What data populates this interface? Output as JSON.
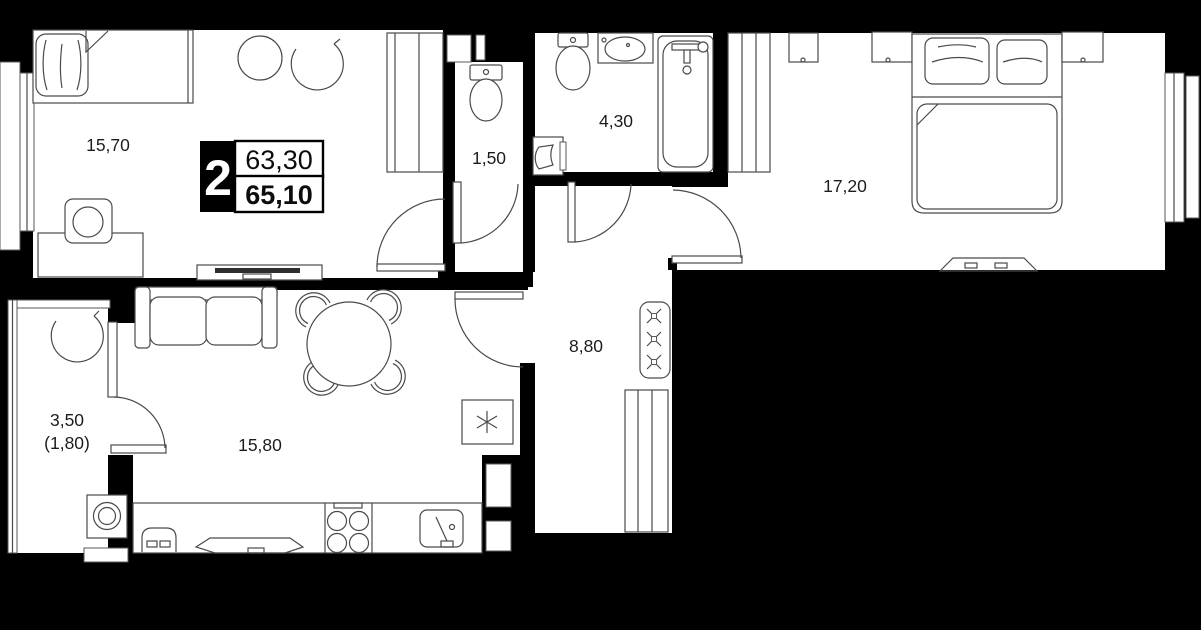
{
  "plan_title": "2-room apartment floor plan",
  "badge": {
    "room_count": "2",
    "area_upper": "63,30",
    "area_lower": "65,10"
  },
  "rooms": {
    "bedroom_1": {
      "label": "15,70"
    },
    "wc": {
      "label": "1,50"
    },
    "bathroom": {
      "label": "4,30"
    },
    "bedroom_2": {
      "label": "17,20"
    },
    "hallway": {
      "label": "8,80"
    },
    "kitchen_living": {
      "label": "15,80"
    },
    "balcony": {
      "label": "3,50",
      "label_secondary": "(1,80)"
    }
  },
  "colors": {
    "background": "#000000",
    "floor": "#ffffff",
    "furniture_line": "#4a4a4a",
    "label_text": "#1c1c1c",
    "badge_block": "#000000"
  },
  "icons": {
    "fridge": "asterisk-star",
    "coat_hooks": "x-cross",
    "legend": [
      "single-bed",
      "double-bed",
      "sofa",
      "round-table",
      "toilet",
      "bathtub",
      "sink",
      "stove",
      "washing-machine",
      "wardrobe"
    ]
  }
}
